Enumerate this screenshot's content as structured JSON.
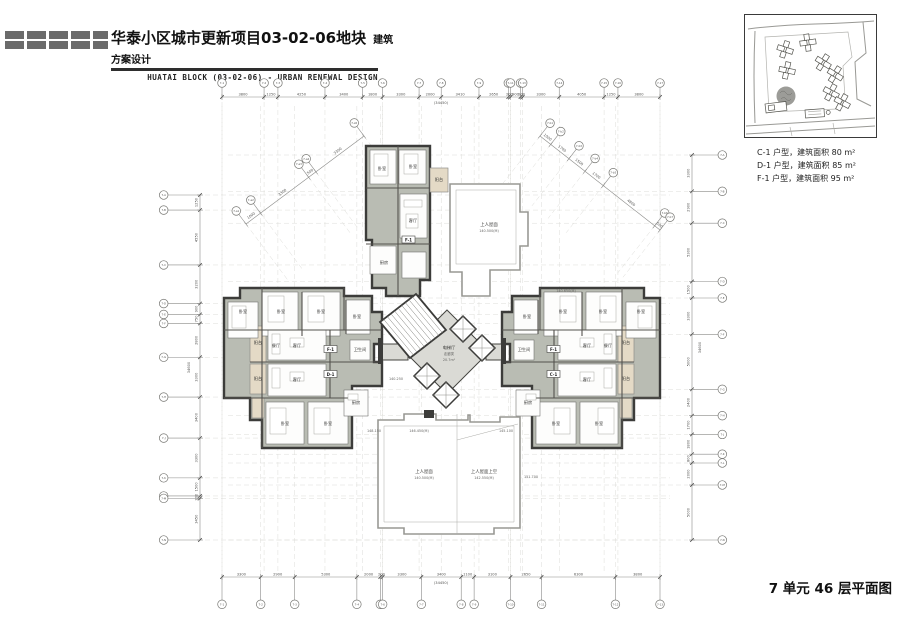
{
  "header": {
    "title_cn": "华泰小区城市更新项目03-02-06地块",
    "title_tag": "建筑方案设计",
    "subtitle_en": "HUATAI BLOCK (03-02-06) - URBAN RENEWAL DESIGN"
  },
  "legend": {
    "items": [
      "C-1 户型，建筑面积 80 m²",
      "D-1 户型，建筑面积 85 m²",
      "F-1 户型，建筑面积 95 m²"
    ]
  },
  "plan_title": "7 单元 46 层平面图",
  "drawing": {
    "colors": {
      "wall": "#3c3c3a",
      "floor": "#b9bcb3",
      "balcony": "#e4dac6",
      "core_floor": "#dadad5",
      "roof_outline": "#9a9a96"
    },
    "dims": {
      "top": [
        "3800",
        "1250",
        "4250",
        "3400",
        "1800",
        "3300",
        "2000",
        "3410",
        "2650",
        "200",
        "900",
        "200",
        "3300",
        "4050",
        "1250",
        "3800"
      ],
      "top_total": "(34450)",
      "bottom": [
        "3300",
        "2900",
        "5300",
        "2000",
        "200",
        "3300",
        "3400",
        "1100",
        "3100",
        "2650",
        "6300",
        "3800"
      ],
      "bottom_total": "(34450)",
      "left": [
        "1250",
        "4550",
        "3200",
        "900",
        "750",
        "2800",
        "3300",
        "3400",
        "3300",
        "1500",
        "200",
        "3450"
      ],
      "left_total": "34600",
      "right": [
        "3300",
        "2900",
        "5300",
        "1500",
        "3300",
        "5000",
        "2400",
        "1700",
        "1800",
        "800",
        "2000",
        "5000"
      ],
      "right_total": "34600",
      "diag_left": [
        "1000",
        "3300",
        "500",
        "3300"
      ],
      "diag_right": [
        "1000",
        "1700",
        "1500",
        "1700",
        "4800",
        "500"
      ]
    },
    "grid_bubbles": {
      "top": [
        "7-1",
        "7-2",
        "7-3",
        "7-4",
        "7-5",
        "7-6",
        "7-7",
        "7-8",
        "7-9",
        "7-10",
        "7-11",
        "7-12",
        "7-13",
        "7-14",
        "7-15",
        "7-16",
        "7-17"
      ],
      "bottom": [
        "7-1",
        "7-2",
        "7-3",
        "7-4",
        "7-5",
        "7-6",
        "7-7",
        "7-8",
        "7-9",
        "7-10",
        "7-11",
        "7-12",
        "7-13"
      ],
      "left": [
        "7-A",
        "7-B",
        "7-C",
        "7-D",
        "7-E",
        "7-F",
        "7-G",
        "7-H",
        "7-J",
        "7-K",
        "7-L",
        "7-M",
        "7-N"
      ],
      "right": [
        "7-A",
        "7-B",
        "7-C",
        "7-D",
        "7-E",
        "7-F",
        "7-G",
        "7-H",
        "7-J",
        "7-K",
        "7-L",
        "7-M",
        "7-N"
      ],
      "diag_left": [
        "7-a1",
        "7-a2",
        "7-a3",
        "7-a4",
        "7-a5"
      ],
      "diag_right": [
        "7-b1",
        "7-b2",
        "7-b3",
        "7-b4",
        "7-b5",
        "7-b6",
        "7-b7"
      ]
    },
    "rooms": {
      "bedroom": "卧室",
      "living": "客厅",
      "dining": "餐厅",
      "kitchen": "厨房",
      "balcony": "阳台",
      "bath": "卫生间"
    },
    "units": {
      "f": "F-1",
      "d": "D-1",
      "c": "C-1"
    },
    "core": {
      "hall": "电梯厅",
      "corridor": "走廊类",
      "area": "20.7m²"
    },
    "roof": {
      "accessible": "上人屋面",
      "above": "上人屋面上空",
      "elev_tr": "140.500(M)",
      "elev_bl": "140.500(M)",
      "elev_br": "142.550(M)",
      "marks": [
        "148.150",
        "146.450(M)",
        "145.100",
        "151.700",
        "140.650(M)",
        "140.250"
      ]
    }
  }
}
